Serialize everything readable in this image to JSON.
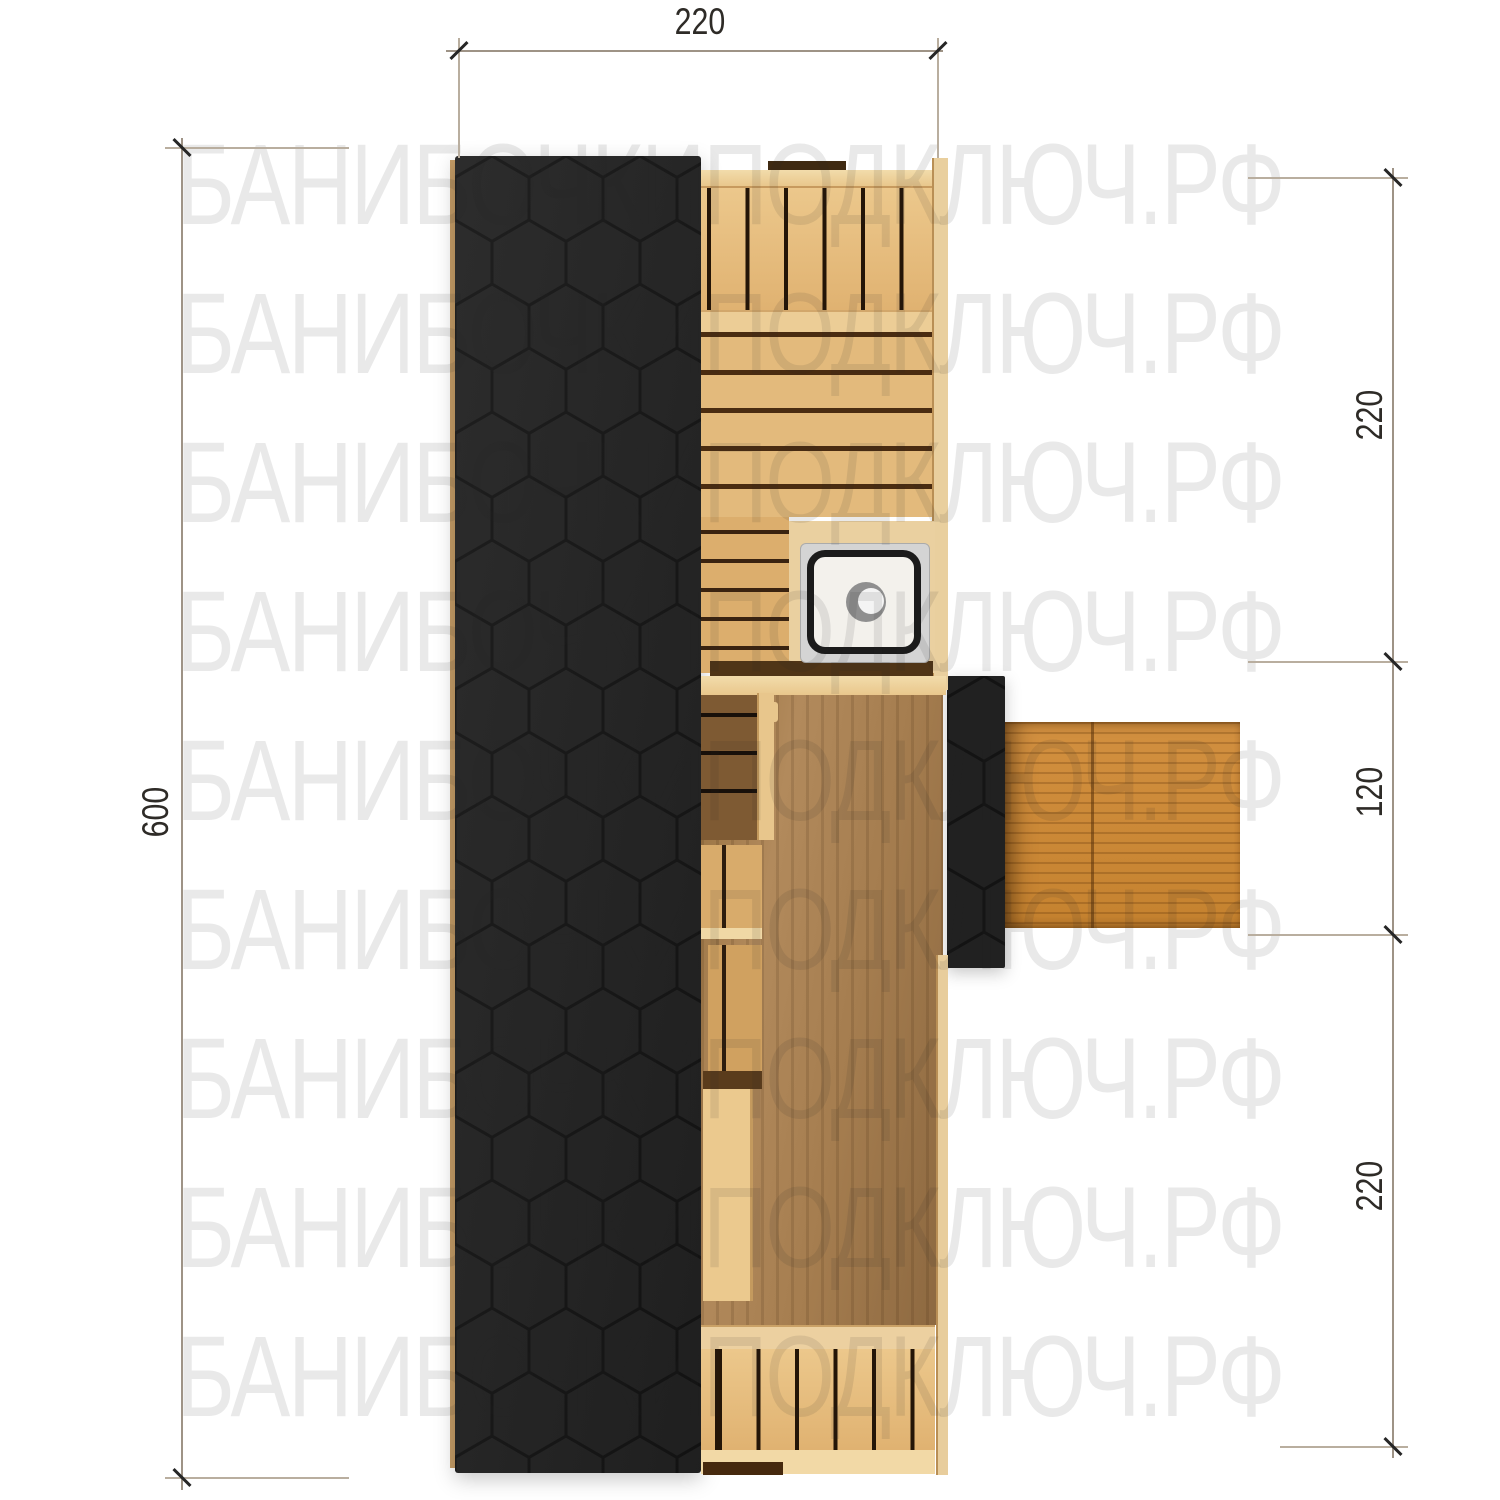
{
  "watermark": {
    "text": "БАНИБОЧКИПОДКЛЮЧ.РФ",
    "rows": 9,
    "appearance_color": "#ececec"
  },
  "dimensions": {
    "top": {
      "label": "220"
    },
    "left": {
      "label": "600"
    },
    "right": [
      {
        "label": "220"
      },
      {
        "label": "120"
      },
      {
        "label": "220"
      }
    ]
  },
  "plan": {
    "type": "sauna-top-view-floor-plan",
    "roof": {
      "pattern": "hexagon-shingles",
      "color": "#1e1e1e",
      "outline": "#161616"
    },
    "wood_light": "#e7c084",
    "wood_seam_dark": "#3a2310",
    "interior_floor": "#a57d4f",
    "entrance_deck": "#cd8a3a",
    "sink": {
      "surround": "#d4d4d4",
      "rim": "#1b1b1b",
      "basin": "#f3f1ec"
    },
    "elements": [
      "main-roof",
      "porch-roof",
      "top-bench-slats",
      "wall-planks",
      "sink-counter",
      "interior-floor",
      "left-benches",
      "storage-crates",
      "bottom-bench-slats",
      "entrance-deck",
      "door-bar",
      "window-bar"
    ]
  }
}
